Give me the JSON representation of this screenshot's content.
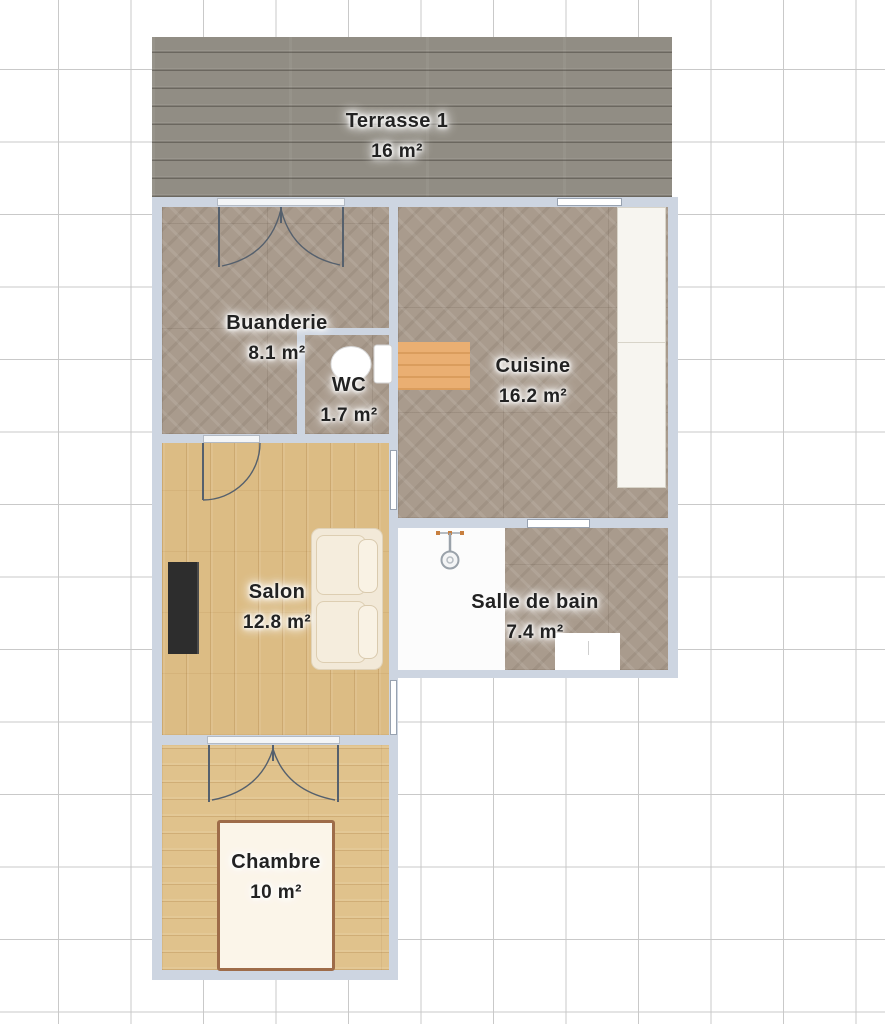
{
  "plan": {
    "rooms": [
      {
        "id": "terrasse-1",
        "name": "Terrasse 1",
        "area": "16 m²"
      },
      {
        "id": "buanderie",
        "name": "Buanderie",
        "area": "8.1 m²"
      },
      {
        "id": "wc",
        "name": "WC",
        "area": "1.7 m²"
      },
      {
        "id": "cuisine",
        "name": "Cuisine",
        "area": "16.2 m²"
      },
      {
        "id": "salon",
        "name": "Salon",
        "area": "12.8 m²"
      },
      {
        "id": "salle-de-bain",
        "name": "Salle de bain",
        "area": "7.4 m²"
      },
      {
        "id": "chambre",
        "name": "Chambre",
        "area": "10 m²"
      }
    ],
    "objects": [
      {
        "icon": "double-door-icon",
        "room": "buanderie"
      },
      {
        "icon": "door-icon",
        "room": "salon"
      },
      {
        "icon": "double-door-icon",
        "room": "chambre"
      },
      {
        "icon": "toilet-icon",
        "room": "wc"
      },
      {
        "icon": "dining-table-icon",
        "room": "cuisine"
      },
      {
        "icon": "kitchen-counter-icon",
        "room": "cuisine"
      },
      {
        "icon": "sofa-icon",
        "room": "salon"
      },
      {
        "icon": "tv-icon",
        "room": "salon"
      },
      {
        "icon": "shower-icon",
        "room": "salle-de-bain"
      },
      {
        "icon": "washing-machine-icon",
        "room": "salle-de-bain"
      },
      {
        "icon": "bed-icon",
        "room": "chambre"
      },
      {
        "icon": "window-icon",
        "room": "walls"
      }
    ],
    "colors": {
      "wall": "#cdd5e1",
      "terrace_deck": "#918d84",
      "parquet": "#a99b8d",
      "salon_wood": "#dcbc84",
      "chambre_wood": "#e0c28c",
      "grid_line": "#c9c9c9",
      "table_wood": "#eaaf72",
      "label_text": "#222222"
    }
  }
}
